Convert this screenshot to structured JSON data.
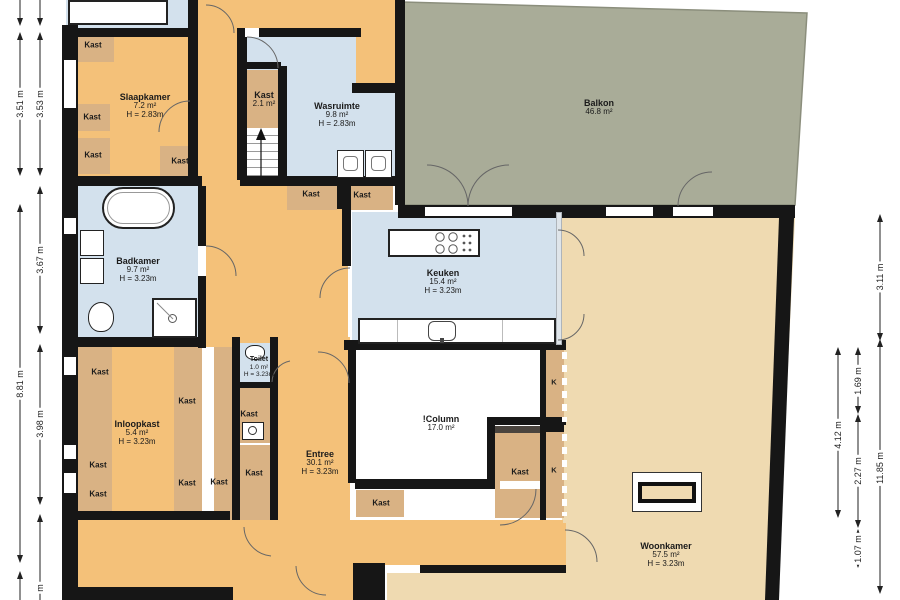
{
  "plan": {
    "rooms": [
      {
        "name": "Slaapkamer",
        "area": "7.2 m²",
        "height": "H = 2.83m"
      },
      {
        "name": "Kast",
        "area": "2.1 m²",
        "height": ""
      },
      {
        "name": "Wasruimte",
        "area": "9.8 m²",
        "height": "H = 2.83m"
      },
      {
        "name": "Balkon",
        "area": "46.8 m²",
        "height": ""
      },
      {
        "name": "Badkamer",
        "area": "9.7 m²",
        "height": "H = 3.23m"
      },
      {
        "name": "Keuken",
        "area": "15.4 m²",
        "height": "H = 3.23m"
      },
      {
        "name": "!Column",
        "area": "17.0 m²",
        "height": ""
      },
      {
        "name": "Toilet",
        "area": "1.0 m²",
        "height": "H = 3.23m"
      },
      {
        "name": "Inloopkast",
        "area": "5.4 m²",
        "height": "H = 3.23m"
      },
      {
        "name": "Entree",
        "area": "30.1 m²",
        "height": "H = 3.23m"
      },
      {
        "name": "Woonkamer",
        "area": "57.5 m²",
        "height": "H = 3.23m"
      }
    ],
    "closet_label": "Kast",
    "k_label": "K",
    "dimensions_left": [
      "3.51 m",
      "3.53 m",
      "3.67 m",
      "8.81 m",
      "3.98 m",
      "m"
    ],
    "dimensions_right": [
      "3.11 m",
      "1.69 m",
      "4.12 m",
      "2.27 m",
      "11.85 m",
      "1.07 m"
    ],
    "colors": {
      "wall": "#161616",
      "hall": "#F4C179",
      "closet": "#D9B284",
      "wet_room": "#D3E1ED",
      "living": "#EFDAB1",
      "balcony": "#A9AC98",
      "column_room": "#FFFFFF"
    }
  }
}
